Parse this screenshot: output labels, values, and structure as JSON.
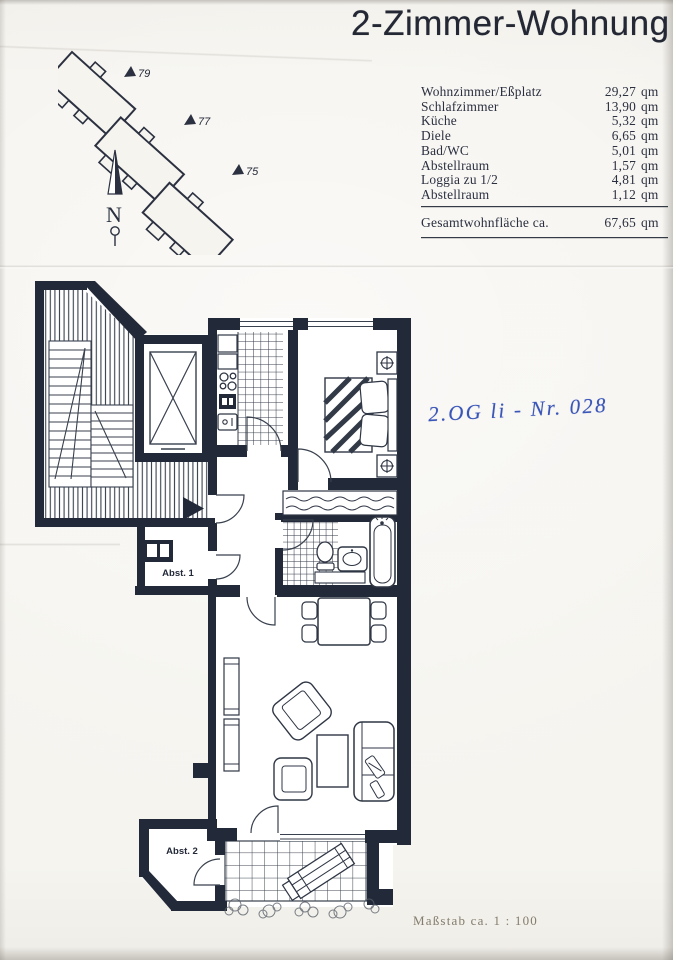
{
  "page": {
    "title": "2-Zimmer-Wohnung",
    "handwritten_note": "2.OG li - Nr. 028",
    "scale_note": "Maßstab ca. 1 : 100"
  },
  "area_table": {
    "rows": [
      {
        "label": "Wohnzimmer/Eßplatz",
        "value": "29,27",
        "unit": "qm"
      },
      {
        "label": "Schlafzimmer",
        "value": "13,90",
        "unit": "qm"
      },
      {
        "label": "Küche",
        "value": "5,32",
        "unit": "qm"
      },
      {
        "label": "Diele",
        "value": "6,65",
        "unit": "qm"
      },
      {
        "label": "Bad/WC",
        "value": "5,01",
        "unit": "qm"
      },
      {
        "label": "Abstellraum",
        "value": "1,57",
        "unit": "qm"
      },
      {
        "label": "Loggia zu 1/2",
        "value": "4,81",
        "unit": "qm"
      },
      {
        "label": "Abstellraum",
        "value": "1,12",
        "unit": "qm"
      }
    ],
    "total": {
      "label": "Gesamtwohnfläche ca.",
      "value": "67,65",
      "unit": "qm"
    }
  },
  "site_plan": {
    "house_numbers": [
      "79",
      "77",
      "75"
    ],
    "north_label": "N"
  },
  "floor_plan": {
    "labels": {
      "storage1": "Abst. 1",
      "storage2": "Abst. 2"
    }
  },
  "colors": {
    "ink": "#222938",
    "handwriting_blue": "#3a55b8",
    "paper": "#f4f2ed"
  }
}
